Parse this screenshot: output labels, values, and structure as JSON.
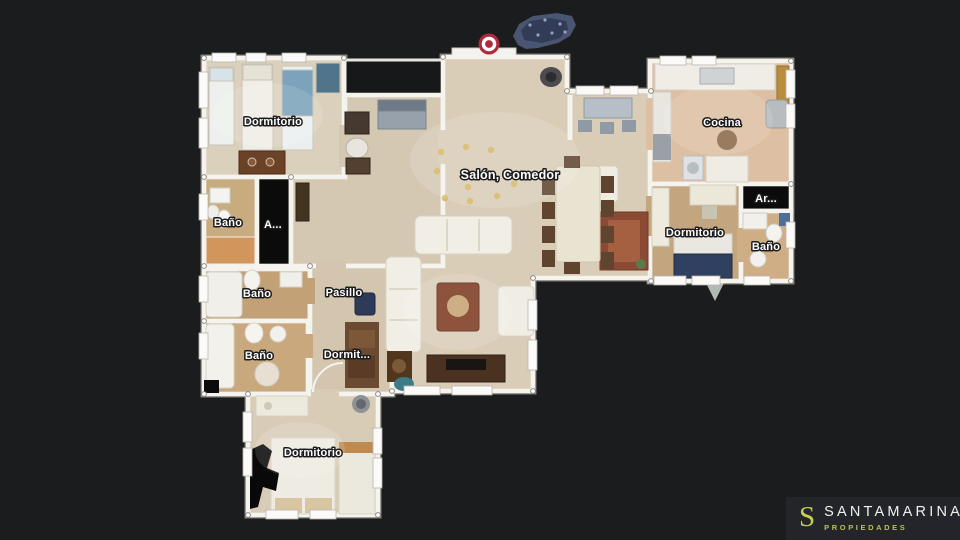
{
  "viewer": {
    "background_color": "#1b1c1e",
    "marker_color": "#b12a3c",
    "wall_color": "#f5f3ee"
  },
  "rooms": [
    {
      "id": "dormitorio-top-left",
      "label": "Dormitorio"
    },
    {
      "id": "bano-left",
      "label": "Baño"
    },
    {
      "id": "armario-left",
      "label": "A..."
    },
    {
      "id": "bano-mid-left",
      "label": "Baño"
    },
    {
      "id": "pasillo",
      "label": "Pasillo"
    },
    {
      "id": "bano-lower-left",
      "label": "Baño"
    },
    {
      "id": "dormitorio-mid",
      "label": "Dormit..."
    },
    {
      "id": "dormitorio-bottom",
      "label": "Dormitorio"
    },
    {
      "id": "salon-comedor",
      "label": "Salón, Comedor"
    },
    {
      "id": "cocina",
      "label": "Cocina"
    },
    {
      "id": "dormitorio-right",
      "label": "Dormitorio"
    },
    {
      "id": "armario-right",
      "label": "Ar..."
    },
    {
      "id": "bano-right",
      "label": "Baño"
    }
  ],
  "logo": {
    "monogram": "S",
    "brand": "SANTAMARINA",
    "tagline": "PROPIEDADES",
    "accent_color": "#c6cf55"
  }
}
